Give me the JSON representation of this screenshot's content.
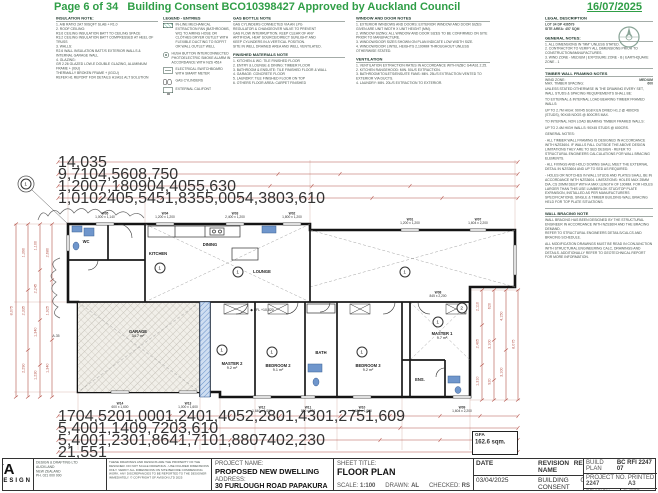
{
  "header": {
    "page": "Page 6 of 34",
    "title": "Building Consent BCO10398427 Approved by Auckland Council",
    "date": "16/07/2025"
  },
  "notes": {
    "insulation": {
      "title": "INSULATION NOTE:",
      "lines": [
        "1. A/B RATIO 2A7 90SQFT SLAB + R1.0",
        "2. ROOF CEILING:",
        "R3.6 CEILING INSULATION BATT TO CEILING SPACE",
        "R3.2 CEILING INSULATION BATT COMPRESSED AT HEEL OF TRUSS",
        "3. WALLS:",
        "R2.6 WALL INSULATION BATT/S EXTERIOR WALLS & INTERNAL GARAGE WALL",
        "4. GLAZING:",
        "GR 2.26 GLAZED LOW-E DOUBLE GLAZING, ALUMINIUM FRAME + (IGU)",
        "THERMALLY BROKEN FRAME + (IGCU)",
        "REFER H1 REPORT FOR DETAILS H1/AS1 ALT SOLUTION"
      ]
    },
    "legend": {
      "title": "LEGEND - ENTRIES",
      "entries": [
        {
          "icon": "extract-fan-icon",
          "cls": "ic-hatch",
          "label": "IN-LINE MECHANICAL EXTRACTION FAN (BATHROOMS, WC) TO AIRING HOSE OR CLOTHES DRYER OUTLET WITH FLEXIBLE DUCTING TO SOFFIT OR WALL OUTLET WELL"
        },
        {
          "icon": "smoke-alarm-icon",
          "cls": "ic-alarm",
          "label": "HUSH BUTTON INTERCONNECTED PHOTOELECTRIC SMOKE ALARM IN ACCORDANCE WITH NZS 4514"
        },
        {
          "icon": "switchboard-icon",
          "cls": "ic-board",
          "label": "ELECTRICAL SWITCHBOARD WITH SMART METER"
        },
        {
          "icon": "gas-cylinders-icon",
          "cls": "ic-gas",
          "label": "GAS CYLINDERS"
        },
        {
          "icon": "califont-icon",
          "cls": "ic-mon",
          "label": "EXTERNAL CALIFONT"
        }
      ]
    },
    "gas_bottle": {
      "title": "GAS BOTTLE NOTE",
      "lines": [
        "GAS CYLINDERS CONNECTED VIA AN LPG",
        "REGULATOR & CHANGEOVER VALVE TO PREVENT",
        "GAS FLOW INTERRUPTION. KEEP CLEAR OF ANY",
        "ARTIFICIAL HEAT SOURCE/DIRECT SUNLIGHT AND",
        "KEEP CYLINDERS IN A VERTICAL POSITION.",
        "SITE IN WELL DRAINED AREA AND WELL VENTILATED."
      ]
    },
    "finished_materials": {
      "title": "FINISHED MATERIALS NOTE",
      "lines": [
        "1. KITCHEN & WC: TILE FINISHED FLOOR",
        "2. ENTRY & LOUNGE & DINING: TIMBER FLOOR",
        "3. BATHROOM & ENSUITE: TILE FINISHED FLOOR & WALL",
        "4. GARAGE: CONCRETE FLOOR",
        "5. LAUNDRY: TILE FINISHED FLOOR ON TOP",
        "6. OTHERS FLOOR AREA: CARPET FINISHED"
      ]
    },
    "window_door": {
      "title": "WINDOW AND DOOR NOTES",
      "lines": [
        "1. EXTERIOR WINDOWS AND DOORS: EXTERIOR WINDOW AND DOOR SIZES GIVEN ARE UNIT WIDTH X UNIT HEIGHT (MM).",
        "2. WINDOW SIZING: ALL WINDOW AND DOOR SIZES TO BE CONFIRMED ON SITE PRIOR TO MANUFACTURE.",
        "3. WINDOW/DOOR SIZES SHOWN ON PLAN INDICATE LOW WIDTH SIZE.",
        "4. WINDOW/DOOR LINTEL HEIGHTS 2,100MM THROUGHOUT UNLESS OTHERWISE STATED."
      ]
    },
    "ventilation": {
      "title": "VENTILATION",
      "lines": [
        "1. VENTILATION EXTRACTION RATES IN ACCORDANCE WITH NZBC G4/AS1 2.25.",
        "2. KITCHEN RANGEHOOD: MIN. 50L/S EXTRACTION.",
        "3. BATHROOM/TOILETS/ENSUITE FANS: MIN. 25L/S EXTRACTION VENTED TO EXTERIOR VIA DUCTS.",
        "4. LAUNDRY: MIN. 20L/S EXTRACTION TO EXTERIOR."
      ]
    }
  },
  "sidebar": {
    "legal": {
      "title": "LEGAL DESCRIPTION",
      "lines": [
        "LOT 34 DP 436579",
        "SITE AREA: 457 SQM"
      ]
    },
    "general": {
      "title": "GENERAL NOTES:",
      "items": [
        "1. ALL DIMENSIONS IN \"MM\" UNLESS STATED.",
        "2. CONTRACTOR TO VERIFY ALL DIMENSIONS PRIOR TO CONSTRUCTION/MANUFACTURES.",
        "3. WIND ZONE - MEDIUM | EXPOSURE ZONE - B | EARTHQUAKE ZONE - 1"
      ]
    },
    "timber": {
      "title": "TIMBER WALL FRAMING NOTES",
      "kv": [
        {
          "k": "WIND ZONE:",
          "v": "MEDIUM"
        },
        {
          "k": "MAX. TIMBER SPACING:",
          "v": "600"
        }
      ],
      "paragraphs": [
        "UNLESS STATED OTHERWISE IN THE DRAWING EVERY SET, WALL STUDS & SPACING REQUIREMENTS SHALL BE:",
        "TO EXTERNAL & INTERNAL LOAD BEARING TIMBER FRAMED WALLS:",
        "UP TO 2.7M HIGH: 90X45 SG8 KILN DRIED H1.2 @ 480CRS (STUDS), 90X45 NOGS @ 800CRS MAX.",
        "TO INTERNAL NON LOAD BEARING TIMBER FRAMED WALLS:",
        "UP TO 2.4M HIGH WALLS: 90X45 STUDS @ 600CRS.",
        "GENERAL NOTES:",
        "- ALL TIMBER WALL FRAMING IS DESIGNED IN ACCORDANCE WITH NZS3604. IF WALLS FALL OUTSIDE THE ABOVE DESIGN LIMITATIONS THEY ARE TO SED DESIGN - REFER TO STRUCTURAL ENGINEERS CALCULATIONS FOR WALL BRACING ELEMENTS.",
        "- ALL FIXINGS AND HOLD DOWNS SHALL MEET THE EXTERNAL DETAIL IN NZS3604 AND UP TO SED AS REQUIRED.",
        "- HOLES OR NOTCHES IN WALL STUDS AND PLATES SHALL BE IN ACCORDANCE WITH NZS3604. LIMITATIONS: HOLES MAX 25MM DIA, CS 20MM DEEP WITH A MAX LENGTH OF 100MM. FOR HOLES LARGER THAN THIS USE LUMBERLOK STUD/TOP PLATE EXPANSION, INSTALLED AS PER MANUFACTURERS SPECIFICATIONS. SINGLE & TIMBER BUILDING WALL BRACING HELD FOR TOP PLATE SITUATIONS."
      ]
    },
    "wall_bracing": {
      "title": "WALL BRACING NOTE",
      "lines": [
        "WALL BRACING HAS BEEN DESIGNED BY THE STRUCTURAL ENGINEER IN ACCORDANCE WITH NZS3604 AND THE BRACING DEMAND.",
        "REFER TO STRUCTURAL ENGINEERS DETAILS/CALCS AND BRACING SCHEDULE."
      ]
    },
    "modification": "ALL MODIFICATION DRAWINGS MUST BE READ IN CONJUNCTION WITH STRUCTURAL ENGINEERING CALC, DRAWINGS AND DETAILS. ADDITIONALLY REFER TO GEOTECHNICAL REPORT FOR MORE INFORMATION."
  },
  "plan": {
    "rooms": [
      {
        "name": "WC",
        "area": "",
        "x": 76,
        "y": 92
      },
      {
        "name": "KITCHEN",
        "area": "",
        "x": 148,
        "y": 104
      },
      {
        "name": "DINING",
        "area": "",
        "x": 200,
        "y": 95
      },
      {
        "name": "LOUNGE",
        "area": "",
        "x": 252,
        "y": 122
      },
      {
        "name": "GARAGE",
        "area": "34.7 m²",
        "x": 128,
        "y": 184
      },
      {
        "name": "MASTER 2",
        "area": "9.2 m²",
        "x": 222,
        "y": 216
      },
      {
        "name": "BEDROOM 2",
        "area": "9.1 m²",
        "x": 268,
        "y": 218
      },
      {
        "name": "BATH",
        "area": "",
        "x": 311,
        "y": 203
      },
      {
        "name": "BEDROOM 3",
        "area": "9.2 m²",
        "x": 358,
        "y": 218
      },
      {
        "name": "MASTER 1",
        "area": "9.7 m²",
        "x": 432,
        "y": 186
      },
      {
        "name": "ENS.",
        "area": "",
        "x": 410,
        "y": 230
      }
    ],
    "markers": [
      {
        "v": "1",
        "x": 16,
        "y": 34
      },
      {
        "v": "1",
        "x": 150,
        "y": 118
      },
      {
        "v": "1",
        "x": 228,
        "y": 122
      },
      {
        "v": "1",
        "x": 395,
        "y": 122
      },
      {
        "v": "1",
        "x": 212,
        "y": 200
      },
      {
        "v": "1",
        "x": 262,
        "y": 202
      },
      {
        "v": "1",
        "x": 352,
        "y": 202
      },
      {
        "v": "1",
        "x": 428,
        "y": 172
      },
      {
        "v": "2",
        "x": 452,
        "y": 158
      }
    ],
    "ffl": {
      "t": "◆ FFL +10,820",
      "x": 252,
      "y": 160
    },
    "misc": [
      {
        "t": "A.35",
        "x": 46,
        "y": 186
      }
    ],
    "windows_top": [
      {
        "tag": "W05",
        "size": "1,000 x 1,140",
        "x": 95,
        "y": 62
      },
      {
        "tag": "W04",
        "size": "1,200 x 1,200",
        "x": 155,
        "y": 62
      },
      {
        "tag": "W03",
        "size": "2,400 x 1,200",
        "x": 225,
        "y": 62
      },
      {
        "tag": "W02",
        "size": "1,800 x 1,200",
        "x": 282,
        "y": 62
      },
      {
        "tag": "W01",
        "size": "1,200 x 1,200",
        "x": 400,
        "y": 68
      }
    ],
    "windows_right": [
      {
        "tag": "W07",
        "size": "1,604 x 2,200",
        "x": 468,
        "y": 68
      },
      {
        "tag": "W08",
        "size": "845 x 2,200",
        "x": 428,
        "y": 141
      }
    ],
    "windows_bottom": [
      {
        "tag": "W14",
        "size": "600 x 1,600",
        "x": 110,
        "y": 252
      },
      {
        "tag": "W13",
        "size": "1,000 x 1,600",
        "x": 178,
        "y": 252
      },
      {
        "tag": "W12",
        "size": "1,640 x 1,600",
        "x": 252,
        "y": 256
      },
      {
        "tag": "W11",
        "size": "800 x 600",
        "x": 298,
        "y": 256
      },
      {
        "tag": "W10",
        "size": "1,640 x 1,600",
        "x": 352,
        "y": 256
      },
      {
        "tag": "W09",
        "size": "1,604 x 2,200",
        "x": 452,
        "y": 256
      }
    ],
    "dims": {
      "t0": [
        "14,035"
      ],
      "t1": [
        "9,710",
        "4,560",
        "8,750"
      ],
      "t2": [
        "1,200",
        "7,180",
        "90",
        "4,405",
        "5,630"
      ],
      "t3": [
        "1,010",
        "240",
        "5,545",
        "1,835",
        "5,005",
        "4,380",
        "3,610"
      ],
      "b0": [
        "170",
        "4,520",
        "1,000",
        "1,240",
        "1,405",
        "2,280",
        "1,430",
        "1,275",
        "1,609"
      ],
      "b1": [
        "5,400",
        "1,140",
        "9,720",
        "3,610"
      ],
      "b2": [
        "5,400",
        "1,230",
        "1,864",
        "1,710",
        "1,880",
        "740",
        "2,230"
      ],
      "b3": [
        "21,551"
      ],
      "l0": [
        "8,075"
      ],
      "l1": [
        "1,390",
        "2,335",
        "2,290"
      ],
      "l2": [
        "1,100",
        "2,245",
        "1,340",
        "1,230"
      ],
      "l3": [
        "2,680",
        "1,925",
        "1,340"
      ],
      "r0": [
        "2,110",
        "2,405",
        "1,310"
      ],
      "r1": [
        "620",
        "3,100",
        "920"
      ],
      "r2": [
        "4,150",
        "3,100"
      ],
      "r3": [
        "8,075"
      ]
    },
    "gfa": {
      "label": "GFA",
      "value": "162.6 sqm."
    }
  },
  "titleblock": {
    "logo_big": "YA",
    "logo_small": "DESIGN",
    "company_lines": [
      "DESIGN & DRAFTING LTD",
      "AUCKLAND",
      "NEW ZEALAND",
      "PH. 021 000 000"
    ],
    "disclaimer": "THESE DRAWINGS AND DESIGNS ARE THE PROPERTY OF THE DESIGNER. DO NOT SCALE DRAWINGS - USE FIGURED DIMENSIONS ONLY. VERIFY ALL DIMENSIONS ON SITE BEFORE COMMENCING WORK. ANY DISCREPANCIES TO BE REPORTED TO THE DESIGNER IMMEDIATELY. © COPYRIGHT OF AVISION LTD 2025",
    "project_label": "PROJECT NAME:",
    "project_value": "PROPOSED NEW DWELLING",
    "address_label": "ADDRESS:",
    "address_value": "30 FURLOUGH ROAD PAPAKURA 2113",
    "sheet_title_label": "SHEET TITLE:",
    "sheet_title_value": "FLOOR PLAN",
    "scale_label": "SCALE:",
    "scale_value": "1:100",
    "drawn_label": "DRAWN:",
    "drawn_value": "AL",
    "checked_label": "CHECKED:",
    "checked_value": "RS",
    "rev_table": {
      "headers": [
        "DATE",
        "REVISION NAME",
        "REV"
      ],
      "rows": [
        [
          "03/04/2025",
          "BUILDING CONSENT",
          "01"
        ],
        [
          "19/06/2025",
          "COUNCIL RFI",
          "02"
        ]
      ]
    },
    "consent_ref_label": "BUILD PLAN",
    "consent_ref": "BC RFI 2247 07",
    "project_no_label": "PROJECT NO.",
    "project_no": "2247",
    "printed_label": "PRINTED",
    "printed": "A3",
    "revision_label": "REVISION",
    "revision_value": "02",
    "sheet_label": "SHEET",
    "sheet_value": "A"
  }
}
